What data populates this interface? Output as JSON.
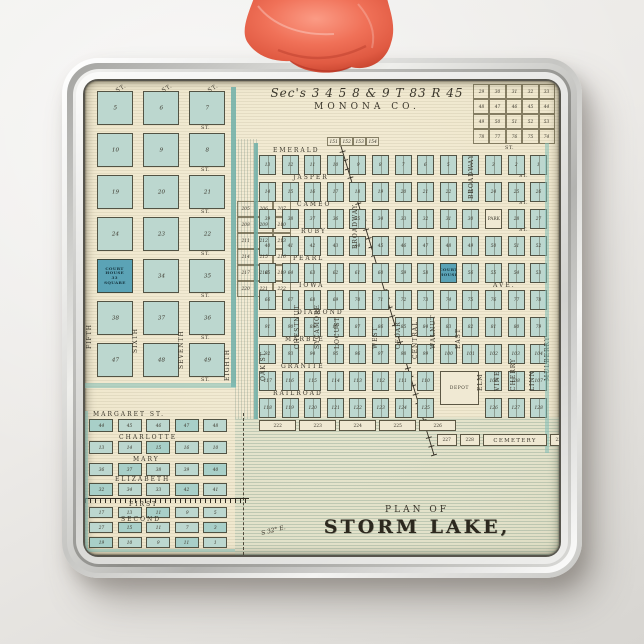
{
  "scene": {
    "description": "Square silver metal ornament with coral satin ribbon, printed with an antique plat map",
    "ribbon_color": "#ee6a55",
    "map_background": "#efe7cd",
    "block_color": "#bcd7cf",
    "accent_teal": "#6eafa8",
    "ink_color": "#3a362b"
  },
  "map": {
    "header": {
      "line1": "Sec's 3 4 5 8 & 9 T 83 R 45",
      "line2": "MONONA CO."
    },
    "title": {
      "line1": "PLAN OF",
      "line2": "STORM LAKE,"
    },
    "corner_table": {
      "rows": [
        [
          "29",
          "30",
          "31",
          "32",
          "33"
        ],
        [
          "48",
          "47",
          "46",
          "45",
          "44"
        ],
        [
          "49",
          "50",
          "51",
          "52",
          "53"
        ],
        [
          "78",
          "77",
          "76",
          "75",
          "74"
        ]
      ]
    },
    "top_box": [
      "151",
      "152",
      "153",
      "154"
    ],
    "left_plat": {
      "v_streets": [
        "FIFTH",
        "SIXTH",
        "SEVENTH",
        "EIGHTH"
      ],
      "st_label": "ST.",
      "rows": [
        [
          "5",
          "6",
          "7"
        ],
        [
          "10",
          "9",
          "8"
        ],
        [
          "19",
          "20",
          "21"
        ],
        [
          "24",
          "23",
          "22"
        ],
        [
          "33",
          "34",
          "35"
        ],
        [
          "38",
          "37",
          "36"
        ],
        [
          "47",
          "48",
          "49"
        ]
      ],
      "courthouse_lines": [
        "COURT",
        "HOUSE",
        "33",
        "SQUARE"
      ]
    },
    "outlot_table": {
      "rows": [
        [
          "205",
          "206",
          "207"
        ],
        [
          "208",
          "209",
          "210"
        ],
        [
          "211",
          "212",
          "213"
        ],
        [
          "214",
          "215",
          "216"
        ],
        [
          "217",
          "218",
          "219"
        ],
        [
          "220",
          "221",
          "222"
        ]
      ]
    },
    "main_plat": {
      "h_streets": [
        "EMERALD",
        "JASPER",
        "CAMEO",
        "RUBY",
        "PEARL",
        "IOWA",
        "DIAMOND",
        "MARBLE",
        "GRANITE",
        "RAILROAD"
      ],
      "ave_label": "AVE.",
      "st_label": "ST.",
      "v_streets": [
        "OAK ST.",
        "CHESTNUT",
        "SYCAMORE",
        "LOCUST",
        "WEST",
        "CEDAR",
        "CENTRAL",
        "WALNUT",
        "EAST",
        "ELM",
        "VINE",
        "CHERRY",
        "LINN",
        "MULBERRY"
      ],
      "broadway": "BROADWAY",
      "special": {
        "park": "PARK",
        "court": "COURT HOUSE",
        "court_lines": [
          "COURT",
          "HOUSE"
        ],
        "depot": "DEPOT",
        "cemetery": "CEMETERY"
      },
      "rows": [
        [
          "13",
          "12",
          "11",
          "10",
          "9",
          "8",
          "7",
          "6",
          "5",
          "4",
          "3",
          "2",
          "1"
        ],
        [
          "14",
          "15",
          "16",
          "17",
          "18",
          "19",
          "20",
          "21",
          "22",
          "23",
          "24",
          "25",
          "26"
        ],
        [
          "39",
          "38",
          "37",
          "36",
          "35",
          "34",
          "33",
          "32",
          "31",
          "30",
          "PARK",
          "28",
          "27"
        ],
        [
          "40",
          "41",
          "42",
          "43",
          "44",
          "45",
          "46",
          "47",
          "48",
          "49",
          "50",
          "51",
          "52"
        ],
        [
          "65",
          "64",
          "63",
          "62",
          "61",
          "60",
          "59",
          "58",
          "COURT HOUSE",
          "56",
          "55",
          "54",
          "53"
        ],
        [
          "66",
          "67",
          "68",
          "69",
          "70",
          "71",
          "72",
          "73",
          "74",
          "75",
          "76",
          "77",
          "78"
        ],
        [
          "91",
          "90",
          "89",
          "88",
          "87",
          "86",
          "85",
          "84",
          "83",
          "82",
          "81",
          "80",
          "79"
        ],
        [
          "92",
          "93",
          "94",
          "95",
          "96",
          "97",
          "98",
          "99",
          "100",
          "101",
          "102",
          "103",
          "104"
        ],
        [
          "117",
          "116",
          "115",
          "114",
          "113",
          "112",
          "111",
          "110",
          "DEPOT",
          "",
          "109",
          "108",
          "107"
        ],
        [
          "118",
          "119",
          "120",
          "121",
          "122",
          "123",
          "124",
          "125",
          "",
          "",
          "126",
          "127",
          "128"
        ]
      ],
      "outlots": [
        "222",
        "223",
        "224",
        "225",
        "226"
      ],
      "cemetery_row": [
        "227",
        "228",
        "CEMETERY",
        "230",
        "231"
      ]
    },
    "small_plat": {
      "h_streets": [
        "MARGARET ST.",
        "CHARLOTTE",
        "MARY",
        "ELIZABETH",
        "FIRST",
        "SECOND"
      ],
      "rows": [
        [
          "44",
          "45",
          "46",
          "47",
          "48"
        ],
        [
          "13",
          "14",
          "15",
          "16",
          "10"
        ],
        [
          "36",
          "37",
          "38",
          "39",
          "40"
        ],
        [
          "32",
          "34",
          "33",
          "42",
          "41"
        ],
        [
          "17",
          "13",
          "11",
          "9",
          "5"
        ],
        [
          "27",
          "15",
          "11",
          "7",
          "3"
        ],
        [
          "19",
          "10",
          "9",
          "11",
          "1"
        ]
      ]
    },
    "annotations": {
      "bearing": "S 32° E."
    }
  }
}
